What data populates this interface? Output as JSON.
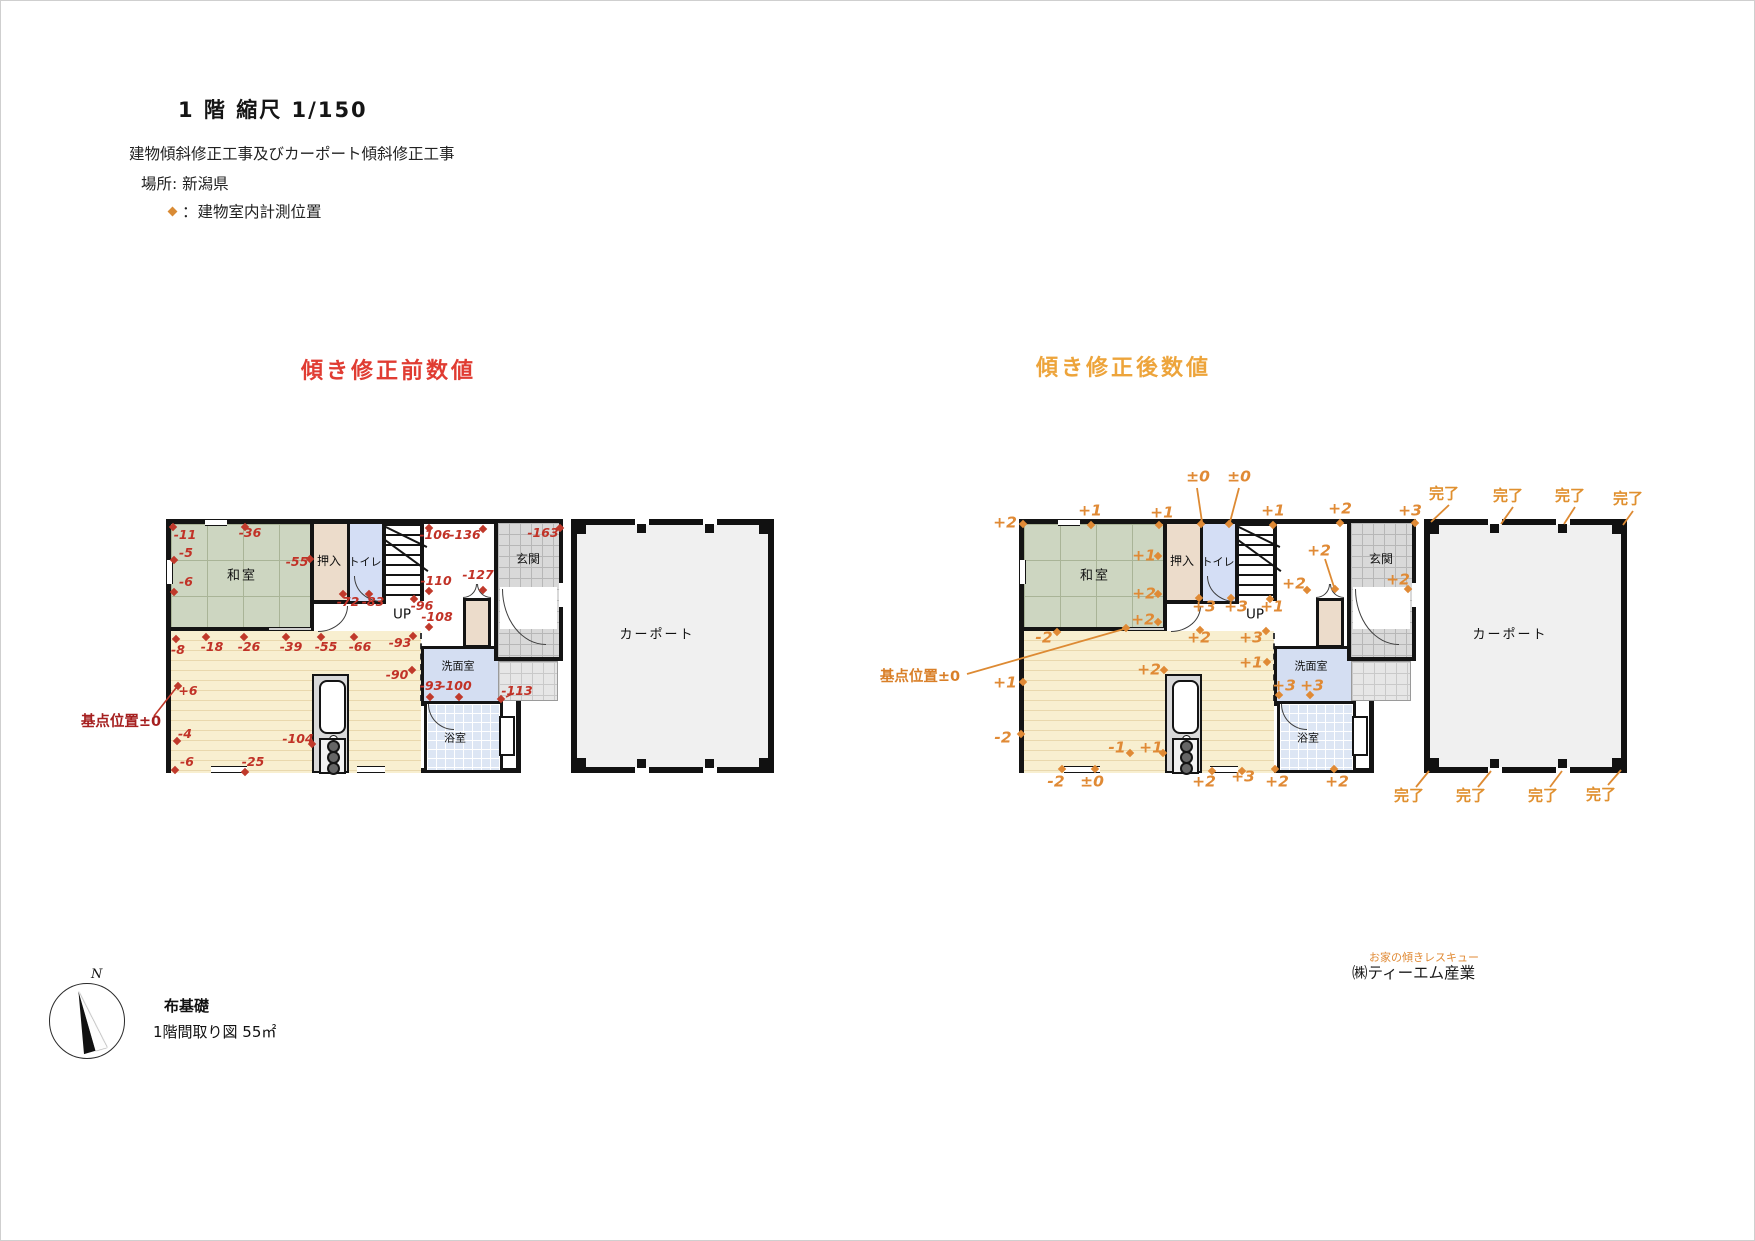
{
  "header": {
    "scale_title": "1 階 縮尺 1/150",
    "project": "建物傾斜修正工事及びカーポート傾斜修正工事",
    "location": "場所: 新潟県",
    "legend": "：建物室内計測位置"
  },
  "footer": {
    "foundation": "布基礎",
    "floor_info": "1階間取り図 55㎡",
    "north": "N"
  },
  "company": {
    "tagline": "お家の傾きレスキュー",
    "name": "㈱ティーエム産業"
  },
  "colors": {
    "before_accent": "#c0392b",
    "after_accent": "#e08a35",
    "before_title": "#e03c32",
    "after_title": "#eda43b",
    "wall": "#141414"
  },
  "plans": {
    "before": {
      "title": "傾き修正前数値",
      "annotations": [
        {
          "t": "和室",
          "k": "room",
          "x": 76,
          "y": 57
        },
        {
          "t": "押入",
          "k": "room-sm",
          "x": 163,
          "y": 42
        },
        {
          "t": "トイレ",
          "k": "room-xs",
          "x": 199,
          "y": 43
        },
        {
          "t": "UP",
          "k": "up",
          "x": 236,
          "y": 96
        },
        {
          "t": "玄関",
          "k": "room-sm",
          "x": 362,
          "y": 40
        },
        {
          "t": "洗面室",
          "k": "room-xs",
          "x": 292,
          "y": 147
        },
        {
          "t": "浴室",
          "k": "room-xs",
          "x": 289,
          "y": 219
        },
        {
          "t": "カーポート",
          "k": "room",
          "x": 491,
          "y": 116
        },
        {
          "t": "-11",
          "k": "num",
          "x": 19,
          "y": 16
        },
        {
          "t": "-36",
          "k": "num",
          "x": 84,
          "y": 14
        },
        {
          "t": "-5",
          "k": "num",
          "x": 20,
          "y": 34
        },
        {
          "t": "-55",
          "k": "num",
          "x": 131,
          "y": 43
        },
        {
          "t": "-6",
          "k": "num",
          "x": 20,
          "y": 63
        },
        {
          "t": "-106",
          "k": "num",
          "x": 269,
          "y": 16
        },
        {
          "t": "-136",
          "k": "num",
          "x": 299,
          "y": 16
        },
        {
          "t": "-163",
          "k": "num",
          "x": 377,
          "y": 14
        },
        {
          "t": "-127",
          "k": "num",
          "x": 312,
          "y": 56
        },
        {
          "t": "-110",
          "k": "num",
          "x": 270,
          "y": 62
        },
        {
          "t": "-96",
          "k": "num",
          "x": 256,
          "y": 87
        },
        {
          "t": "-72",
          "k": "num",
          "x": 182,
          "y": 83
        },
        {
          "t": "-83",
          "k": "num",
          "x": 207,
          "y": 83
        },
        {
          "t": "-108",
          "k": "num",
          "x": 271,
          "y": 98
        },
        {
          "t": "-8",
          "k": "num",
          "x": 12,
          "y": 131
        },
        {
          "t": "-18",
          "k": "num",
          "x": 46,
          "y": 128
        },
        {
          "t": "-26",
          "k": "num",
          "x": 83,
          "y": 128
        },
        {
          "t": "-39",
          "k": "num",
          "x": 125,
          "y": 128
        },
        {
          "t": "-55",
          "k": "num",
          "x": 160,
          "y": 128
        },
        {
          "t": "-66",
          "k": "num",
          "x": 194,
          "y": 128
        },
        {
          "t": "-93",
          "k": "num",
          "x": 234,
          "y": 124
        },
        {
          "t": "-90",
          "k": "num",
          "x": 231,
          "y": 156
        },
        {
          "t": "+6",
          "k": "num",
          "x": 22,
          "y": 172
        },
        {
          "t": "-4",
          "k": "num",
          "x": 19,
          "y": 215
        },
        {
          "t": "-104",
          "k": "num",
          "x": 132,
          "y": 220
        },
        {
          "t": "-6",
          "k": "num",
          "x": 21,
          "y": 243
        },
        {
          "t": "-25",
          "k": "num",
          "x": 87,
          "y": 243
        },
        {
          "t": "-93",
          "k": "num",
          "x": 265,
          "y": 167
        },
        {
          "t": "-100",
          "k": "num",
          "x": 290,
          "y": 167
        },
        {
          "t": "-113",
          "k": "num",
          "x": 351,
          "y": 172
        },
        {
          "t": "基点位置±0",
          "k": "base",
          "x": -45,
          "y": 203
        }
      ],
      "dots": [
        [
          7,
          8
        ],
        [
          79,
          8
        ],
        [
          8,
          41
        ],
        [
          144,
          40
        ],
        [
          8,
          73
        ],
        [
          263,
          9
        ],
        [
          317,
          10
        ],
        [
          394,
          9
        ],
        [
          317,
          71
        ],
        [
          263,
          72
        ],
        [
          248,
          80
        ],
        [
          177,
          75
        ],
        [
          203,
          75
        ],
        [
          263,
          108
        ],
        [
          10,
          120
        ],
        [
          40,
          118
        ],
        [
          78,
          118
        ],
        [
          120,
          118
        ],
        [
          155,
          118
        ],
        [
          188,
          118
        ],
        [
          247,
          117
        ],
        [
          246,
          151
        ],
        [
          12,
          167
        ],
        [
          11,
          222
        ],
        [
          146,
          225
        ],
        [
          9,
          251
        ],
        [
          79,
          253
        ],
        [
          264,
          178
        ],
        [
          293,
          178
        ],
        [
          335,
          180
        ]
      ],
      "lines": [
        [
          -12,
          197,
          10,
          169
        ],
        [
          340,
          178,
          348,
          174
        ]
      ]
    },
    "after": {
      "title": "傾き修正後数値",
      "annotations": [
        {
          "t": "和室",
          "k": "room",
          "x": 76,
          "y": 57
        },
        {
          "t": "押入",
          "k": "room-sm",
          "x": 163,
          "y": 42
        },
        {
          "t": "トイレ",
          "k": "room-xs",
          "x": 199,
          "y": 43
        },
        {
          "t": "UP",
          "k": "up",
          "x": 236,
          "y": 96
        },
        {
          "t": "玄関",
          "k": "room-sm",
          "x": 362,
          "y": 40
        },
        {
          "t": "洗面室",
          "k": "room-xs",
          "x": 292,
          "y": 147
        },
        {
          "t": "浴室",
          "k": "room-xs",
          "x": 289,
          "y": 219
        },
        {
          "t": "カーポート",
          "k": "room",
          "x": 491,
          "y": 116
        },
        {
          "t": "+2",
          "k": "num",
          "x": -14,
          "y": 4
        },
        {
          "t": "+1",
          "k": "num",
          "x": 71,
          "y": -8
        },
        {
          "t": "+1",
          "k": "num",
          "x": 143,
          "y": -6
        },
        {
          "t": "±0",
          "k": "num",
          "x": 179,
          "y": -42
        },
        {
          "t": "±0",
          "k": "num",
          "x": 220,
          "y": -42
        },
        {
          "t": "+1",
          "k": "num",
          "x": 254,
          "y": -8
        },
        {
          "t": "+2",
          "k": "num",
          "x": 321,
          "y": -10
        },
        {
          "t": "+3",
          "k": "num",
          "x": 391,
          "y": -8
        },
        {
          "t": "+1",
          "k": "num",
          "x": 125,
          "y": 37
        },
        {
          "t": "+2",
          "k": "num",
          "x": 125,
          "y": 75
        },
        {
          "t": "+3",
          "k": "num",
          "x": 185,
          "y": 88
        },
        {
          "t": "+3",
          "k": "num",
          "x": 217,
          "y": 88
        },
        {
          "t": "+1",
          "k": "num",
          "x": 253,
          "y": 88
        },
        {
          "t": "+2",
          "k": "num",
          "x": 300,
          "y": 32
        },
        {
          "t": "+2",
          "k": "num",
          "x": 275,
          "y": 65
        },
        {
          "t": "+2",
          "k": "num",
          "x": 379,
          "y": 61
        },
        {
          "t": "+2",
          "k": "num",
          "x": 124,
          "y": 101
        },
        {
          "t": "-2",
          "k": "num",
          "x": 25,
          "y": 119
        },
        {
          "t": "+1",
          "k": "num",
          "x": -14,
          "y": 164
        },
        {
          "t": "+2",
          "k": "num",
          "x": 130,
          "y": 151
        },
        {
          "t": "+2",
          "k": "num",
          "x": 180,
          "y": 119
        },
        {
          "t": "+3",
          "k": "num",
          "x": 232,
          "y": 119
        },
        {
          "t": "+1",
          "k": "num",
          "x": 232,
          "y": 144
        },
        {
          "t": "+3",
          "k": "num",
          "x": 265,
          "y": 167
        },
        {
          "t": "+3",
          "k": "num",
          "x": 293,
          "y": 167
        },
        {
          "t": "-2",
          "k": "num",
          "x": -16,
          "y": 219
        },
        {
          "t": "-1",
          "k": "num",
          "x": 98,
          "y": 229
        },
        {
          "t": "+1",
          "k": "num",
          "x": 132,
          "y": 229
        },
        {
          "t": "-2",
          "k": "num",
          "x": 37,
          "y": 263
        },
        {
          "t": "±0",
          "k": "num",
          "x": 73,
          "y": 263
        },
        {
          "t": "+2",
          "k": "num",
          "x": 185,
          "y": 263
        },
        {
          "t": "+3",
          "k": "num",
          "x": 224,
          "y": 258
        },
        {
          "t": "+2",
          "k": "num",
          "x": 258,
          "y": 263
        },
        {
          "t": "+2",
          "k": "num",
          "x": 318,
          "y": 263
        },
        {
          "t": "完了",
          "k": "done",
          "x": 425,
          "y": -25
        },
        {
          "t": "完了",
          "k": "done",
          "x": 489,
          "y": -23
        },
        {
          "t": "完了",
          "k": "done",
          "x": 551,
          "y": -23
        },
        {
          "t": "完了",
          "k": "done",
          "x": 609,
          "y": -20
        },
        {
          "t": "完了",
          "k": "done",
          "x": 390,
          "y": 277
        },
        {
          "t": "完了",
          "k": "done",
          "x": 452,
          "y": 277
        },
        {
          "t": "完了",
          "k": "done",
          "x": 524,
          "y": 277
        },
        {
          "t": "完了",
          "k": "done",
          "x": 582,
          "y": 276
        },
        {
          "t": "基点位置±0",
          "k": "base",
          "x": -99,
          "y": 158
        }
      ],
      "dots": [
        [
          4,
          5
        ],
        [
          72,
          6
        ],
        [
          140,
          6
        ],
        [
          182,
          5
        ],
        [
          210,
          5
        ],
        [
          254,
          6
        ],
        [
          321,
          4
        ],
        [
          396,
          4
        ],
        [
          139,
          37
        ],
        [
          139,
          75
        ],
        [
          180,
          79
        ],
        [
          212,
          79
        ],
        [
          251,
          80
        ],
        [
          316,
          70
        ],
        [
          288,
          71
        ],
        [
          389,
          70
        ],
        [
          139,
          103
        ],
        [
          38,
          113
        ],
        [
          107,
          109
        ],
        [
          4,
          163
        ],
        [
          145,
          151
        ],
        [
          181,
          111
        ],
        [
          247,
          112
        ],
        [
          248,
          143
        ],
        [
          260,
          176
        ],
        [
          291,
          176
        ],
        [
          2,
          215
        ],
        [
          111,
          234
        ],
        [
          144,
          234
        ],
        [
          43,
          250
        ],
        [
          76,
          250
        ],
        [
          193,
          252
        ],
        [
          223,
          252
        ],
        [
          256,
          250
        ],
        [
          315,
          250
        ]
      ],
      "lines": [
        [
          178,
          -31,
          183,
          3
        ],
        [
          220,
          -31,
          211,
          3
        ],
        [
          -52,
          155,
          105,
          110
        ],
        [
          306,
          40,
          315,
          68
        ],
        [
          430,
          -14,
          412,
          3
        ],
        [
          494,
          -12,
          482,
          5
        ],
        [
          556,
          -12,
          545,
          5
        ],
        [
          614,
          -8,
          604,
          6
        ],
        [
          397,
          268,
          410,
          252
        ],
        [
          459,
          268,
          472,
          252
        ],
        [
          531,
          268,
          543,
          252
        ],
        [
          589,
          266,
          602,
          251
        ]
      ]
    }
  }
}
